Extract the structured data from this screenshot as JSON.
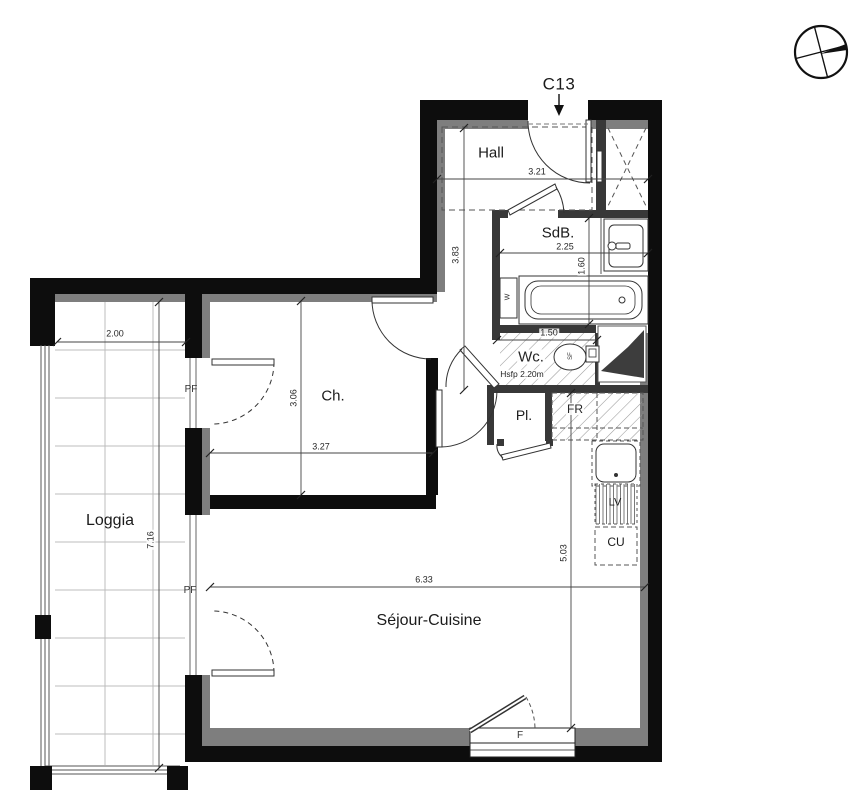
{
  "unit": {
    "code": "C13"
  },
  "rooms": {
    "hall": {
      "label": "Hall"
    },
    "sdb": {
      "label": "SdB."
    },
    "wc": {
      "label": "Wc.",
      "height_note": "Hsfp 2.20m"
    },
    "ch": {
      "label": "Ch."
    },
    "pl": {
      "label": "Pl."
    },
    "fr": {
      "label": "FR"
    },
    "lv": {
      "label": "LV"
    },
    "cu": {
      "label": "CU"
    },
    "loggia": {
      "label": "Loggia"
    },
    "sejour": {
      "label": "Séjour-Cuisine"
    }
  },
  "openings": {
    "window_f": "F",
    "pf_ch": "PF",
    "pf_sejour": "PF",
    "w_fixture": "W",
    "sf_fixture": "SF"
  },
  "dimensions": {
    "hall_width": "3.21",
    "hall_depth": "3.83",
    "sdb_width": "2.25",
    "sdb_depth": "1.60",
    "wc_width": "1.50",
    "ch_depth": "3.06",
    "ch_width": "3.27",
    "loggia_width": "2.00",
    "loggia_depth": "7.16",
    "sejour_width": "6.33",
    "sejour_depth": "5.03"
  }
}
